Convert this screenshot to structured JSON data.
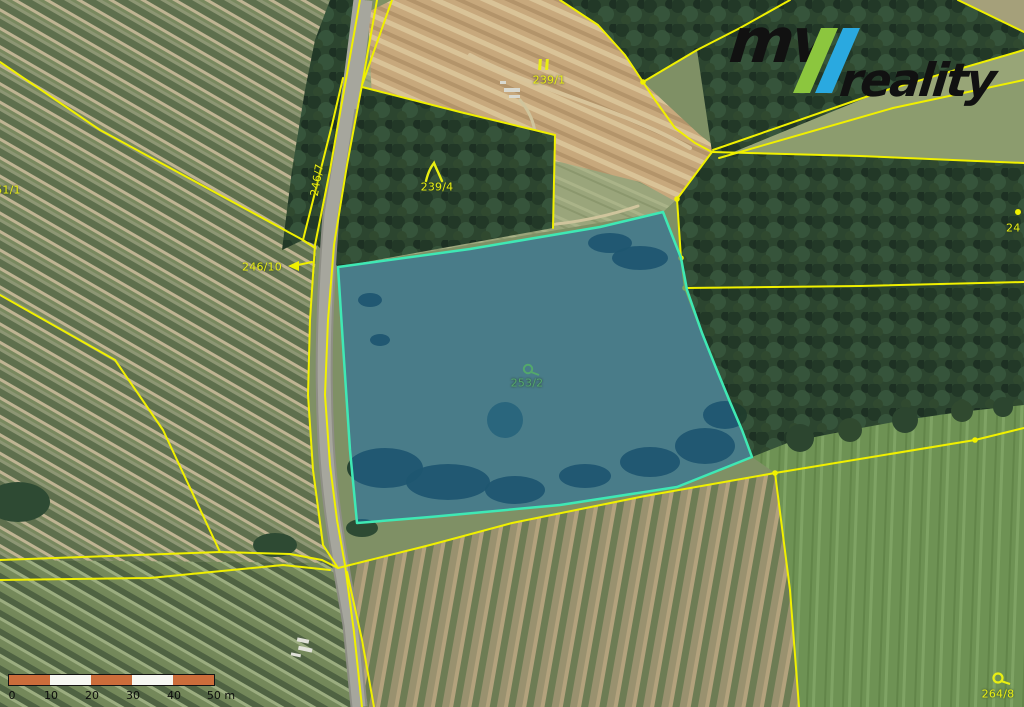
{
  "map": {
    "parcel_labels": [
      {
        "number": "251/1",
        "marker": "none"
      },
      {
        "number": "246/7",
        "marker": "none"
      },
      {
        "number": "246/10",
        "marker": "arrow"
      },
      {
        "number": "239/4",
        "marker": "forest-lambda"
      },
      {
        "number": "239/1",
        "marker": "meadow-bars"
      },
      {
        "number": "253/2",
        "marker": "pasture-circle"
      },
      {
        "number": "24",
        "marker": "dot"
      },
      {
        "number": "264/8",
        "marker": "pasture-circle"
      }
    ],
    "highlighted_parcel": {
      "number": "253/2",
      "fill": "#1e6ca8",
      "border": "#3fe8b4"
    },
    "cadastral_line_color": "#f0f000",
    "label_color_yellow": "#e9ef12",
    "label_color_green": "#53a86b"
  },
  "logo": {
    "text_mv": "mv",
    "text_reality": "reality",
    "color_green": "#8cc63e",
    "color_blue": "#2aa9e0",
    "color_text": "#111111"
  },
  "scale_bar": {
    "tick_labels": [
      "0",
      "10",
      "20",
      "30",
      "40",
      "50 m"
    ],
    "bar_colors": [
      "#cc6d3b",
      "#f7f7f2"
    ]
  }
}
